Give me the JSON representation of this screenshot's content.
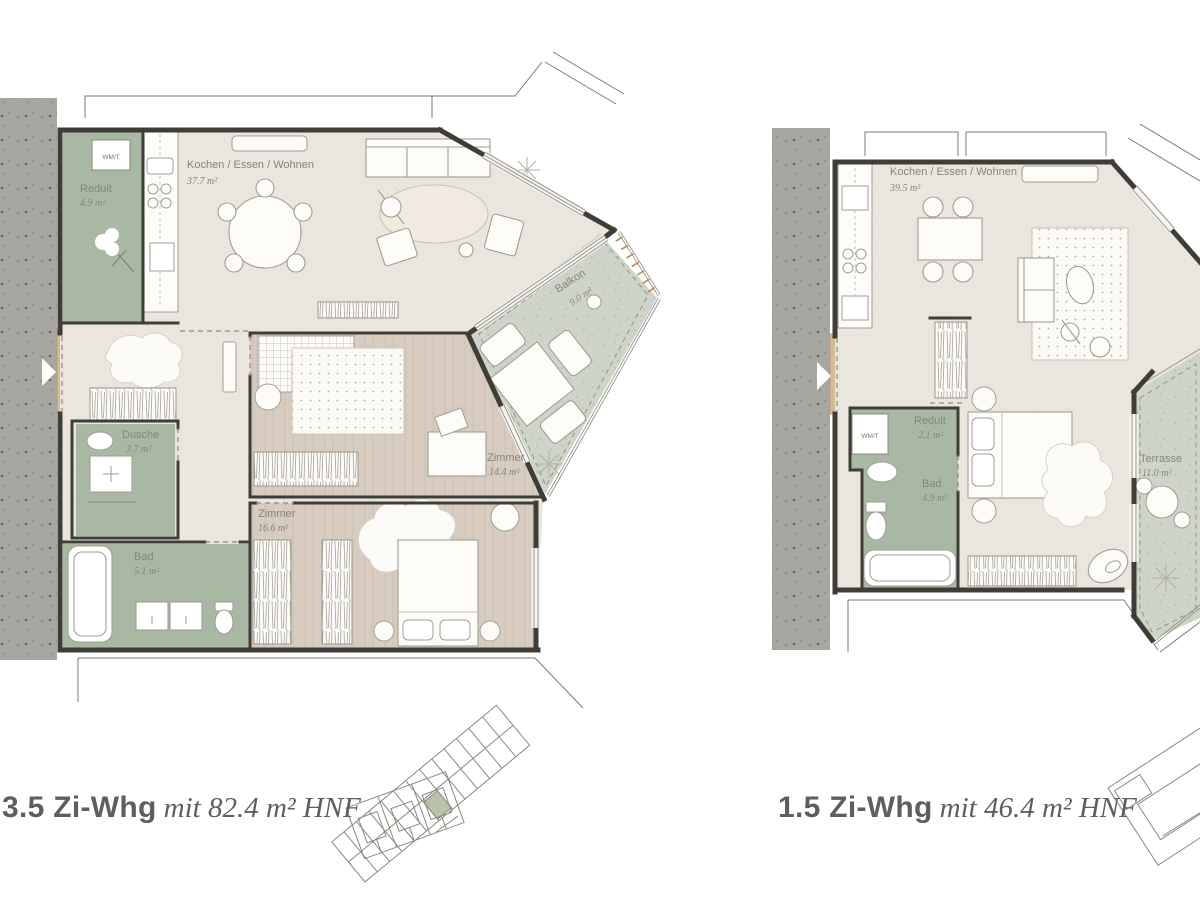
{
  "left_plan": {
    "title_bold": "3.5 Zi-Whg",
    "title_italic": "mit 82.4 m² HNF",
    "wmt": "WM/T",
    "rooms": {
      "reduit": {
        "name": "Reduit",
        "area": "4.9 m²"
      },
      "kochen": {
        "name": "Kochen / Essen / Wohnen",
        "area": "37.7 m²"
      },
      "balkon": {
        "name": "Balkon",
        "area": "9.0 m²"
      },
      "dusche": {
        "name": "Dusche",
        "area": "3.7 m²"
      },
      "zimmer1": {
        "name": "Zimmer",
        "area": "14.4 m²"
      },
      "zimmer2": {
        "name": "Zimmer",
        "area": "16.6 m²"
      },
      "bad": {
        "name": "Bad",
        "area": "5.1 m²"
      }
    }
  },
  "right_plan": {
    "title_bold": "1.5 Zi-Whg",
    "title_italic": "mit 46.4 m² HNF",
    "wmt": "WM/T",
    "rooms": {
      "kochen": {
        "name": "Kochen / Essen / Wohnen",
        "area": "39.5 m²"
      },
      "reduit": {
        "name": "Reduit",
        "area": "2.1 m²"
      },
      "bad": {
        "name": "Bad",
        "area": "4.9 m²"
      },
      "terrasse": {
        "name": "Terrasse",
        "area": "11.0 m²"
      }
    }
  },
  "colors": {
    "wall": "#3e3d38",
    "concrete": "#a8a6a1",
    "floor_beige": "#ebe6dd",
    "floor_wood": "#d8ccc0",
    "room_green": "#a8b8a2",
    "outdoor_green": "#cfd4c8",
    "entry_door_tan": "#d5ba92",
    "railing_ticks": "#bd8a52",
    "label_text": "#87857b",
    "title_text": "#5e5e5e",
    "key_plan_highlight": "#b7c3ab"
  }
}
